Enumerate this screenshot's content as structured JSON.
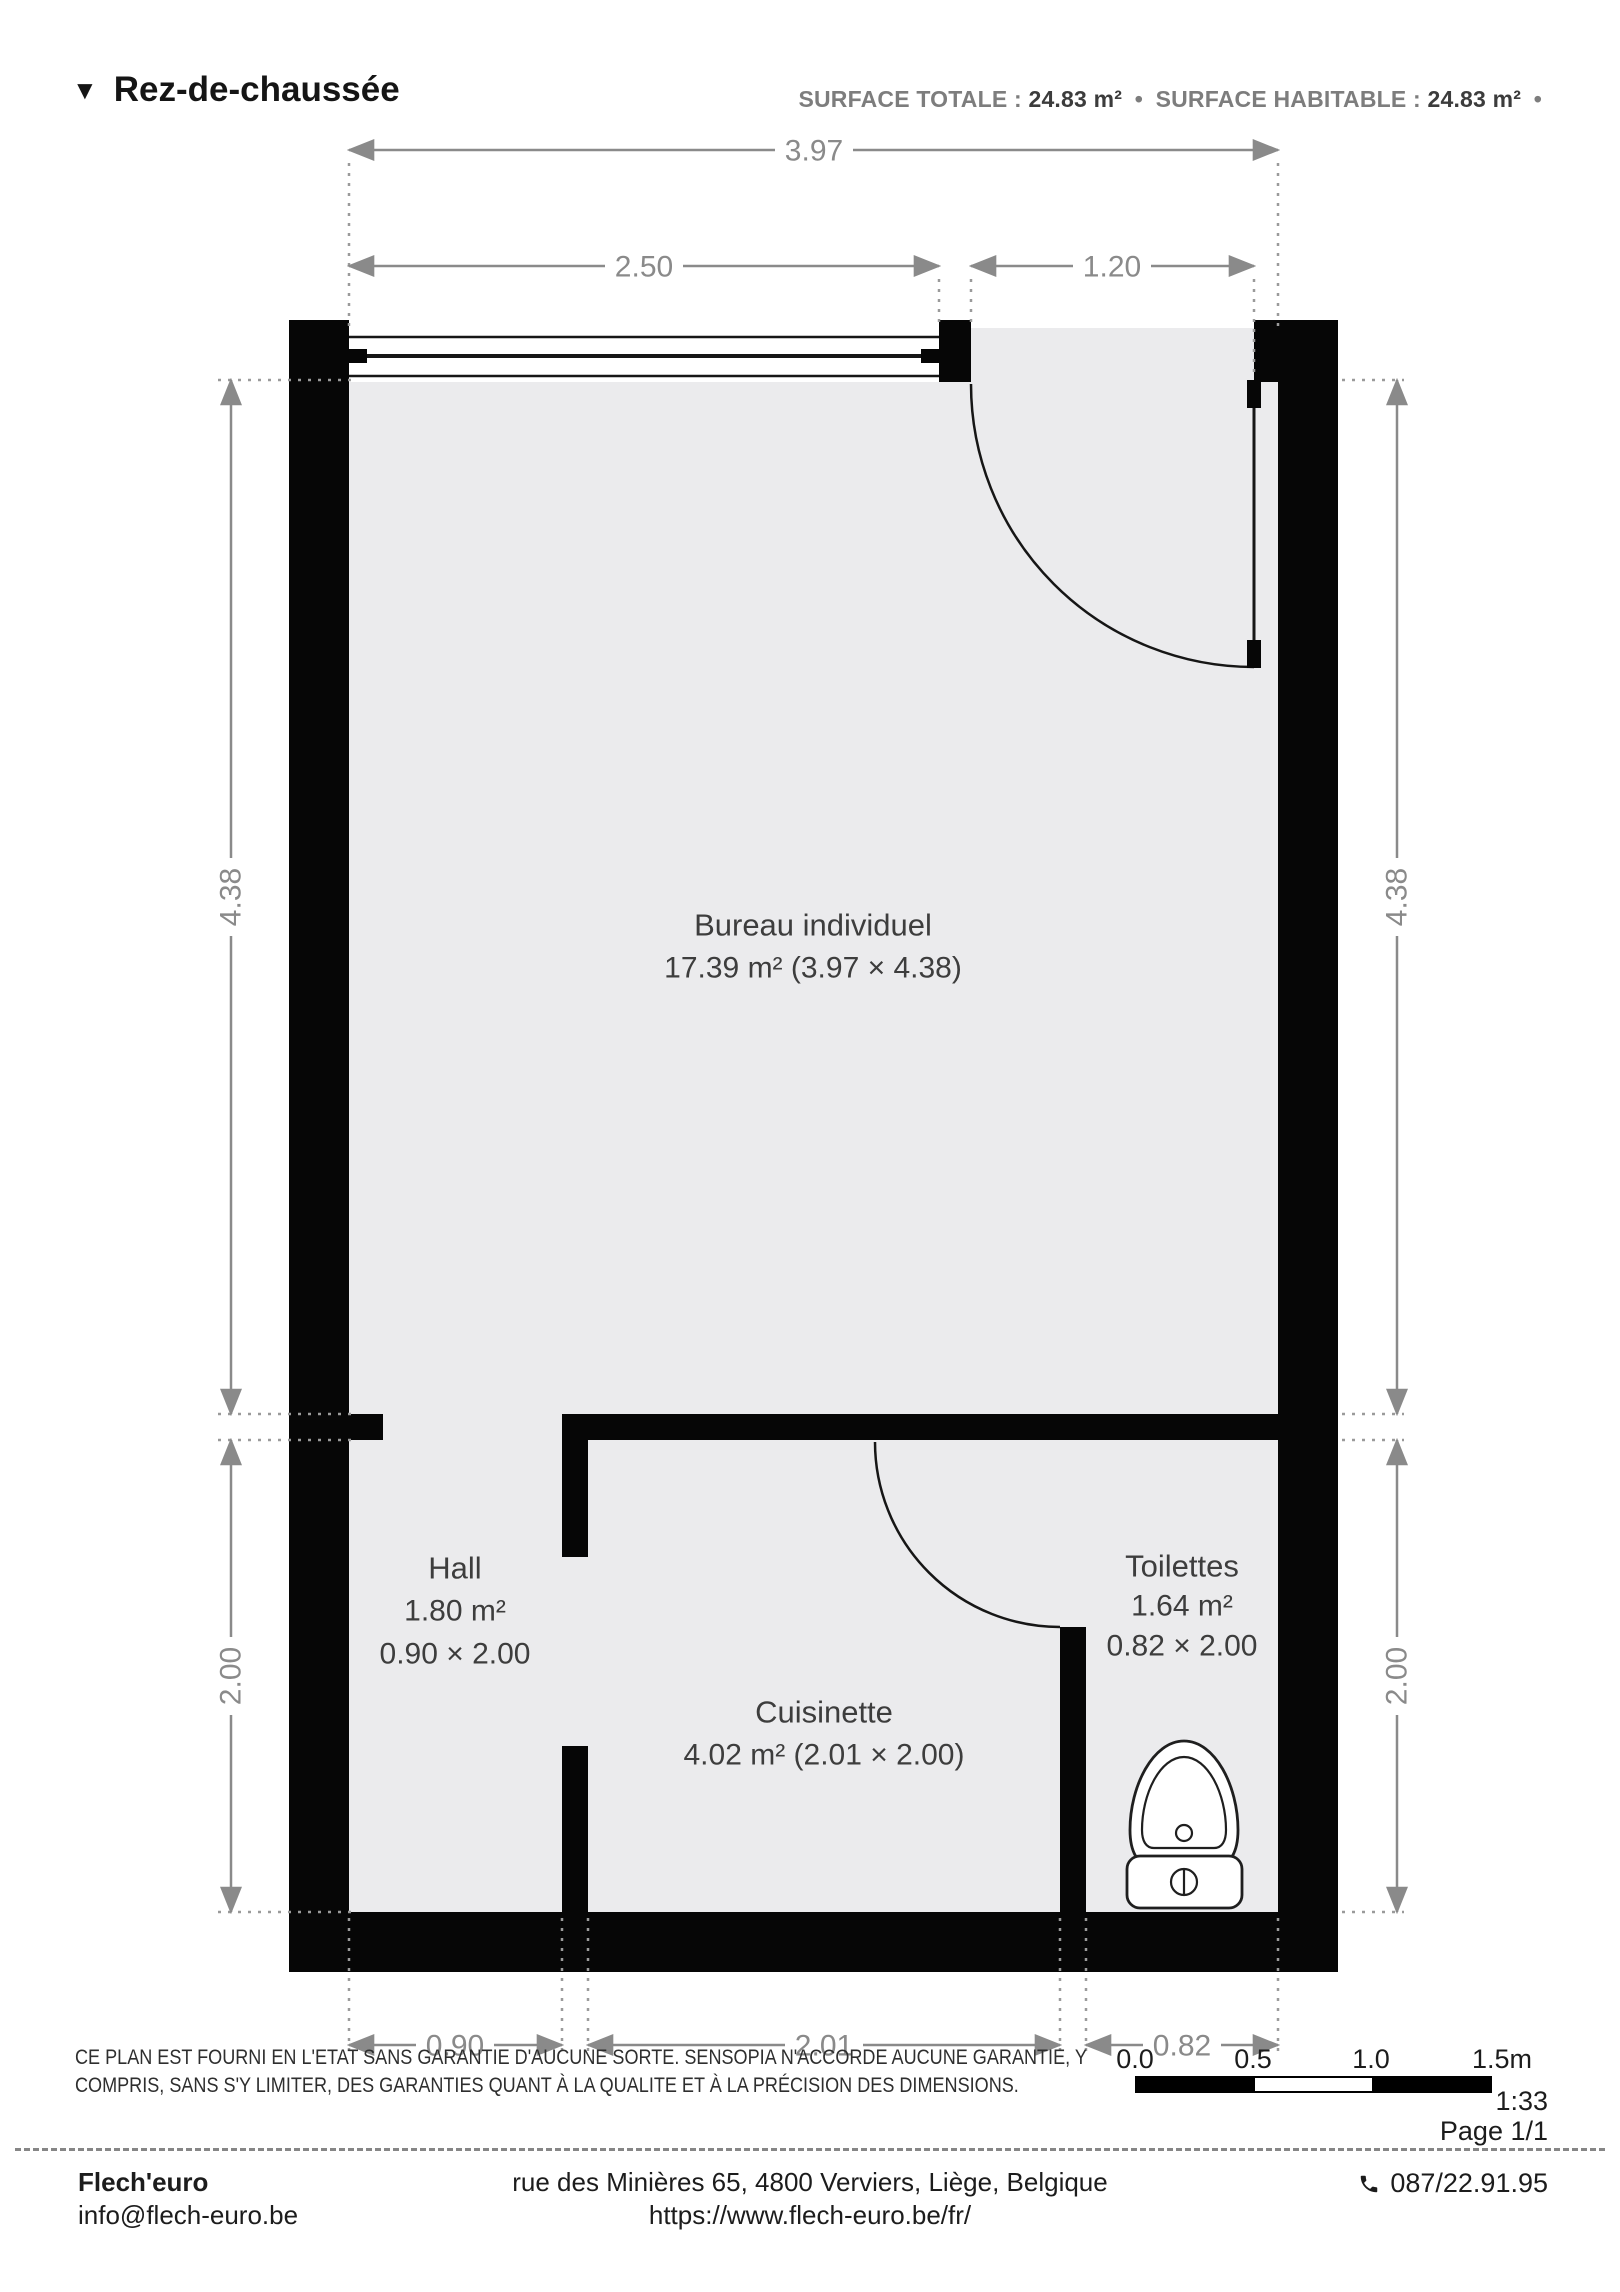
{
  "header": {
    "marker_icon": "▼",
    "title": "Rez-de-chaussée",
    "surface_total_label": "SURFACE TOTALE :",
    "surface_total_value": "24.83 m²",
    "dot": "•",
    "surface_habitable_label": "SURFACE HABITABLE :",
    "surface_habitable_value": "24.83 m²"
  },
  "plan": {
    "dims": {
      "total_width": "3.97",
      "window_width": "2.50",
      "door_width": "1.20",
      "side_upper": "4.38",
      "side_lower": "2.00",
      "hall_width": "0.90",
      "cuisinette_width": "2.01",
      "toilettes_width": "0.82"
    },
    "rooms": {
      "bureau": {
        "name": "Bureau individuel",
        "details": "17.39 m² (3.97 × 4.38)"
      },
      "hall": {
        "name": "Hall",
        "area": "1.80 m²",
        "size": "0.90 × 2.00"
      },
      "cuisinette": {
        "name": "Cuisinette",
        "details": "4.02 m² (2.01 × 2.00)"
      },
      "toilettes": {
        "name": "Toilettes",
        "area": "1.64 m²",
        "size": "0.82 × 2.00"
      }
    }
  },
  "disclaimer": {
    "line1": "CE PLAN EST FOURNI EN L'ETAT SANS GARANTIE D'AUCUNE SORTE. SENSOPIA N'ACCORDE AUCUNE GARANTIE, Y",
    "line2": "COMPRIS, SANS S'Y LIMITER, DES GARANTIES QUANT À LA QUALITE ET À LA PRÉCISION DES DIMENSIONS."
  },
  "scalebar": {
    "t0": "0.0",
    "t1": "0.5",
    "t2": "1.0",
    "t3": "1.5m",
    "ratio": "1:33",
    "page": "Page 1/1"
  },
  "footer": {
    "company": "Flech'euro",
    "email": "info@flech-euro.be",
    "address": "rue des Minières 65, 4800 Verviers, Liège, Belgique",
    "website": "https://www.flech-euro.be/fr/",
    "phone": "087/22.91.95"
  },
  "colors": {
    "wall": "#060606",
    "floor": "#ebebed",
    "dimension": "#8a8a8a",
    "label": "#3d3d3d"
  }
}
